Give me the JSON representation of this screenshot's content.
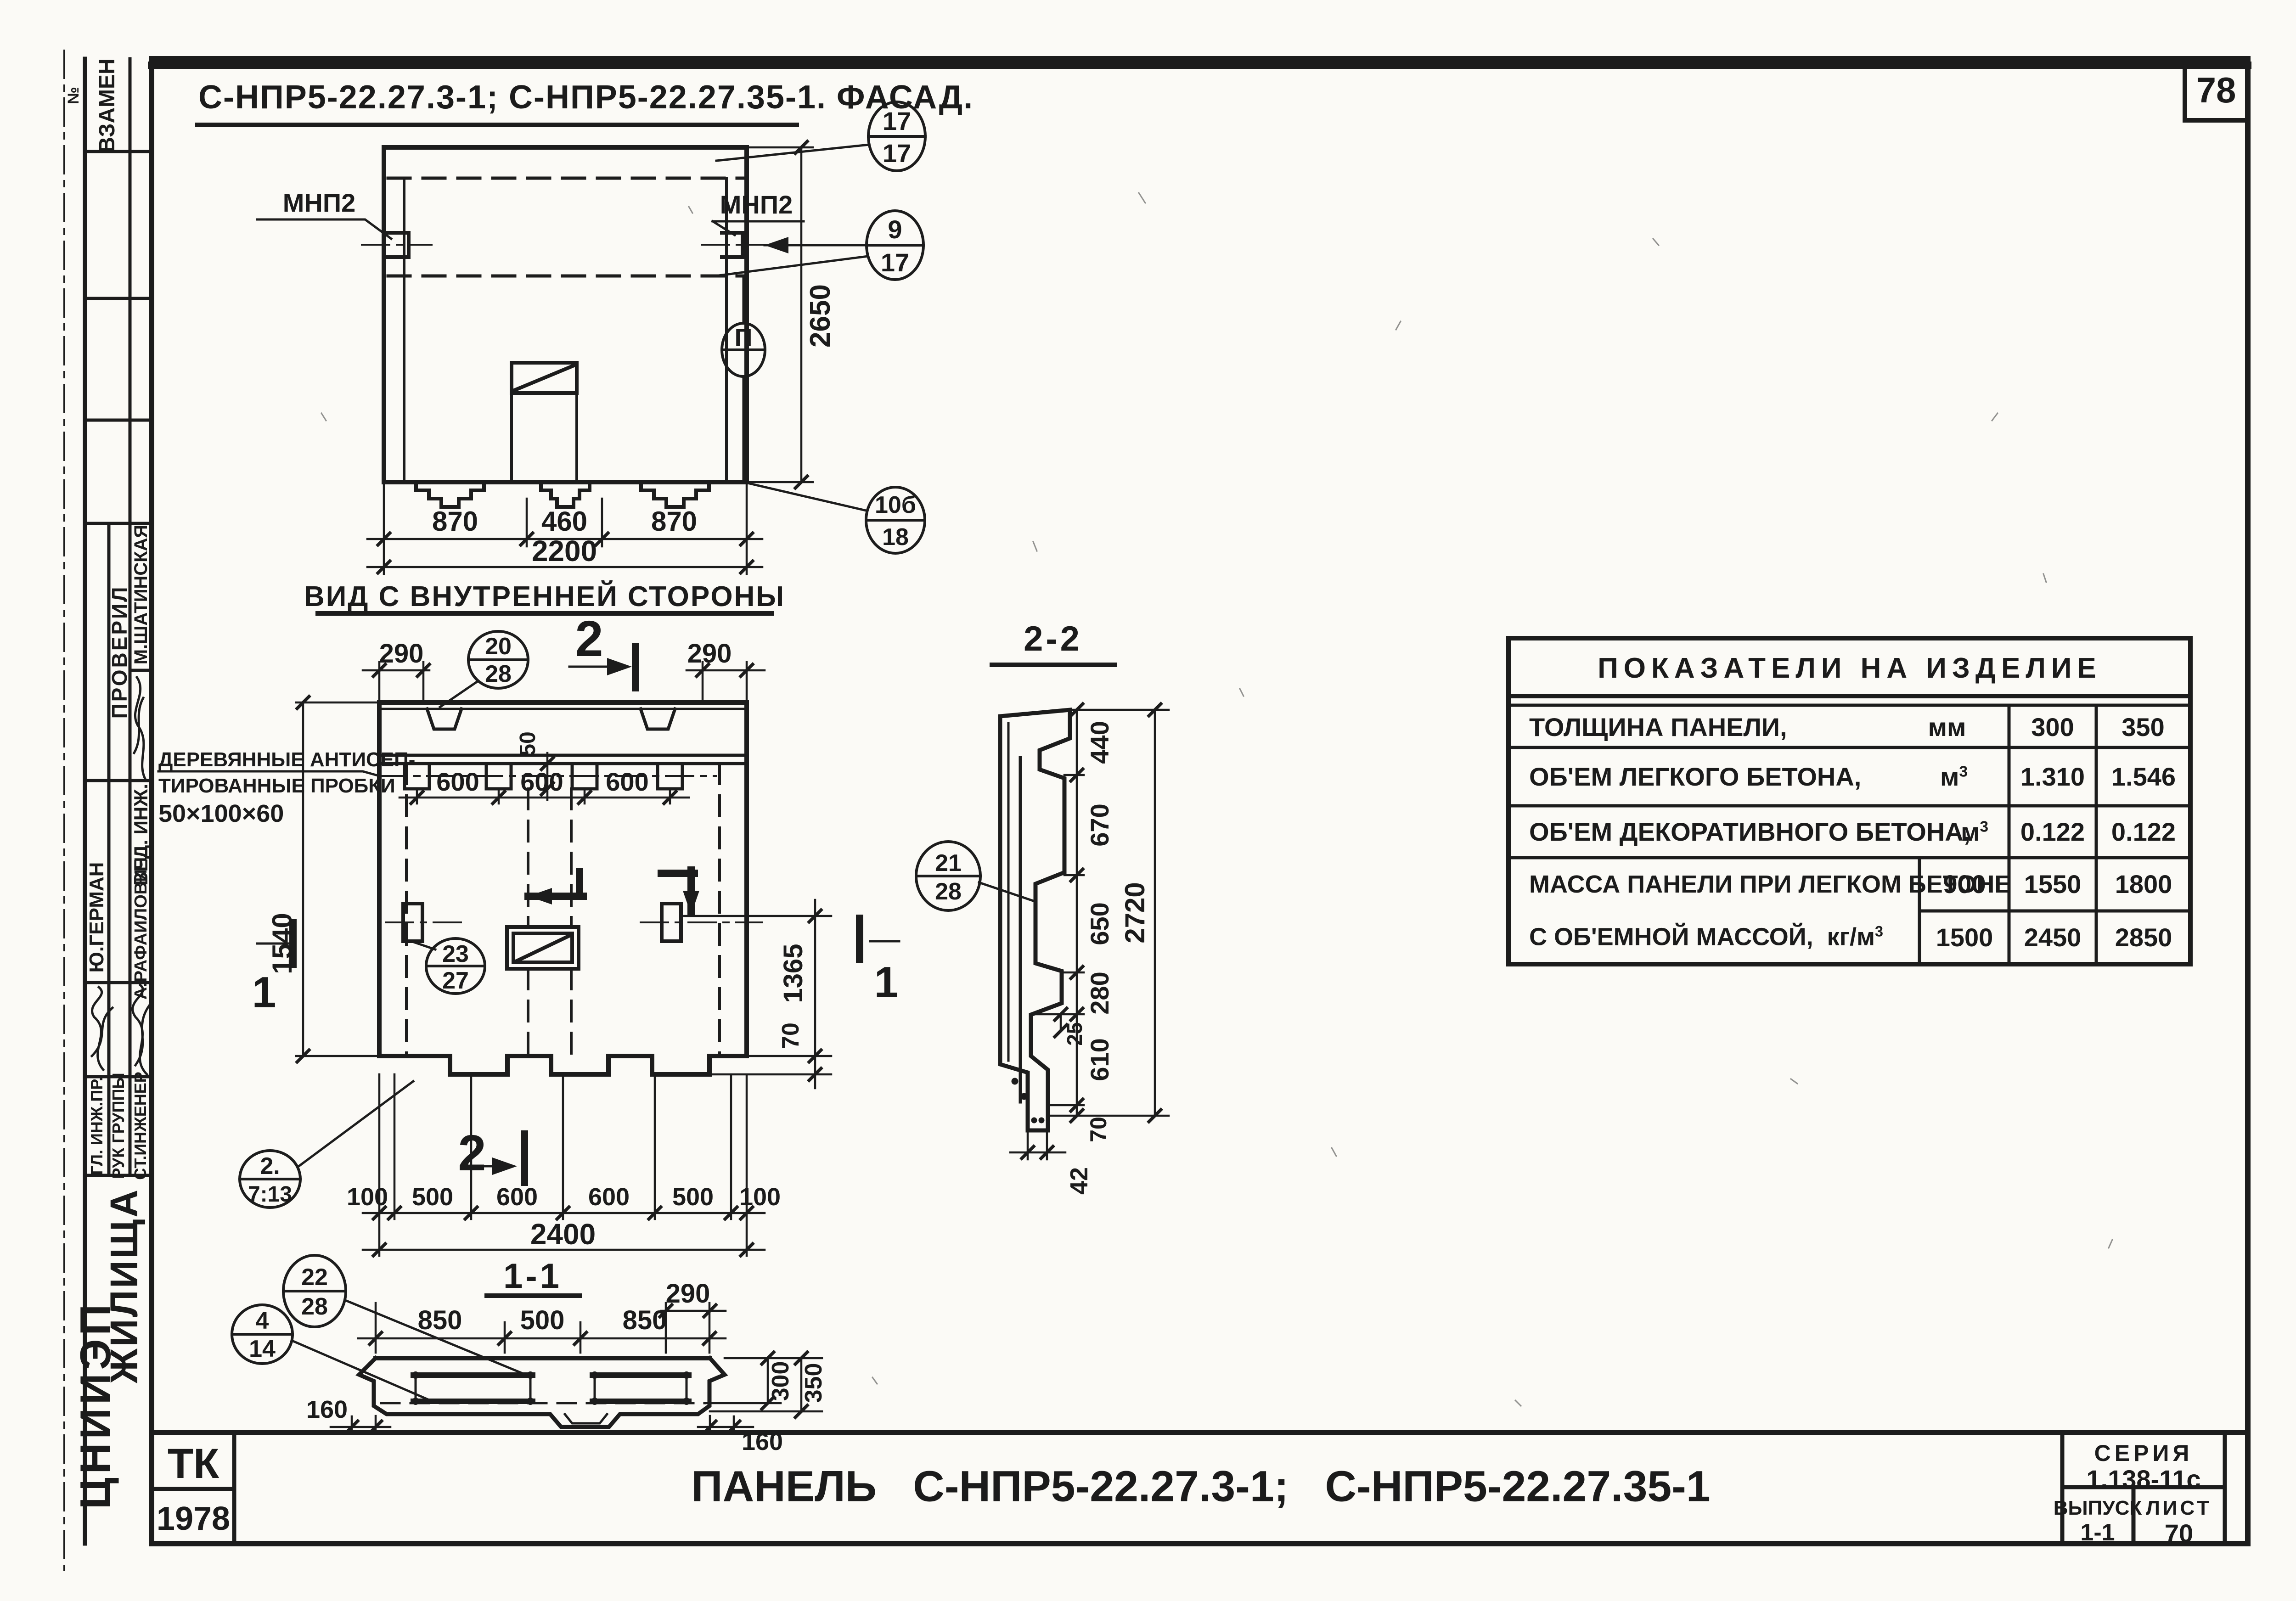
{
  "colors": {
    "ink": "#1c1c1c",
    "paper": "#fbfaf6"
  },
  "sheet": {
    "number": "78",
    "footer_title": "ПАНЕЛЬ   С-НПР5-22.27.3-1;   С-НПР5-22.27.35-1"
  },
  "header": {
    "title": "С-НПР5-22.27.3-1; С-НПР5-22.27.35-1. ФАСАД."
  },
  "facade": {
    "mnp2_left": "МНП2",
    "mnp2_right": "МНП2",
    "dims": {
      "w1": "870",
      "w2": "460",
      "w3": "870",
      "total": "2200",
      "height": "2650"
    },
    "callouts": {
      "top": {
        "n": "17",
        "d": "17"
      },
      "mid": {
        "n": "9",
        "d": "17"
      },
      "axis": "П",
      "bottom": {
        "n": "10б",
        "d": "18"
      }
    }
  },
  "inner": {
    "title": "ВИД С ВНУТРЕННЕЙ СТОРОНЫ",
    "note": [
      "ДЕРЕВЯННЫЕ АНТИСЕП-",
      "ТИРОВАННЫЕ ПРОБКИ",
      "50×100×60"
    ],
    "dims": {
      "left290": "290",
      "right290": "290",
      "plug50": "50",
      "s600": [
        "600",
        "600",
        "600"
      ],
      "h1540": "1540",
      "h1365": "1365",
      "h70": "70",
      "bottom": [
        "100",
        "500",
        "600",
        "600",
        "500",
        "100"
      ],
      "total": "2400"
    },
    "callouts": {
      "c2028": {
        "n": "20",
        "d": "28"
      },
      "c2327": {
        "n": "23",
        "d": "27"
      },
      "c713": {
        "n": "2.",
        "d": "7:13"
      }
    },
    "marks": {
      "s2_top": "2",
      "s2_bottom": "2",
      "s1_left": "1",
      "s1_right": "1"
    }
  },
  "s22": {
    "title": "2-2",
    "dims": {
      "d440": "440",
      "d670": "670",
      "d650": "650",
      "d280": "280",
      "d610": "610",
      "d70": "70",
      "d25": "25",
      "d42": "42",
      "total": "2720"
    },
    "callout": {
      "n": "21",
      "d": "28"
    }
  },
  "s11": {
    "title": "1-1",
    "dims": {
      "w1": "850",
      "w2": "500",
      "w3": "850",
      "d290": "290",
      "l160": "160",
      "r160": "160",
      "t300": "300",
      "t350": "350"
    },
    "callouts": {
      "c2228": {
        "n": "22",
        "d": "28"
      },
      "c414": {
        "n": "4",
        "d": "14"
      }
    }
  },
  "table": {
    "title": "ПОКАЗАТЕЛИ  НА  ИЗДЕЛИЕ",
    "rows": [
      {
        "label": "ТОЛЩИНА ПАНЕЛИ,",
        "unit": "мм",
        "sup": "",
        "v1": "300",
        "v2": "350"
      },
      {
        "label": "ОБ'ЕМ ЛЕГКОГО БЕТОНА,",
        "unit": "м",
        "sup": "3",
        "v1": "1.310",
        "v2": "1.546"
      },
      {
        "label": "ОБ'ЕМ ДЕКОРАТИВНОГО БЕТОНА,",
        "unit": "м",
        "sup": "3",
        "v1": "0.122",
        "v2": "0.122"
      }
    ],
    "mass": {
      "label1": "МАССА ПАНЕЛИ ПРИ ЛЕГКОМ БЕТОНЕ",
      "label2": "С ОБ'ЕМНОЙ МАССОЙ,  кг/м",
      "sup": "3",
      "r1": {
        "d": "900",
        "v1": "1550",
        "v2": "1800"
      },
      "r2": {
        "d": "1500",
        "v1": "2450",
        "v2": "2850"
      }
    }
  },
  "tblock": {
    "series_label": "СЕРИЯ",
    "series": "1.138-11с",
    "issue_label": "ВЫПУСК",
    "issue": "1-1",
    "sheet_label": "ЛИСТ",
    "sheet": "70",
    "tk": "ТК",
    "year": "1978"
  },
  "stamp": {
    "no": "№",
    "vzamen": "ВЗАМЕН",
    "proveril": "ПРОВЕРИЛ",
    "name1": "М.ШАТИНСКАЯ",
    "role1": "ВЕД. ИНЖ.",
    "name2": "А.РАФАИЛОВИЧ",
    "name3": "Ю.ГЕРМАН",
    "role_gl": "ГЛ. ИНЖ.ПР.",
    "role_ruk": "РУК ГРУППЫ",
    "role_st": "СТ.ИНЖЕНЕР",
    "dept": "ЖИЛИЩА",
    "org": "ЦНИИЭП"
  }
}
